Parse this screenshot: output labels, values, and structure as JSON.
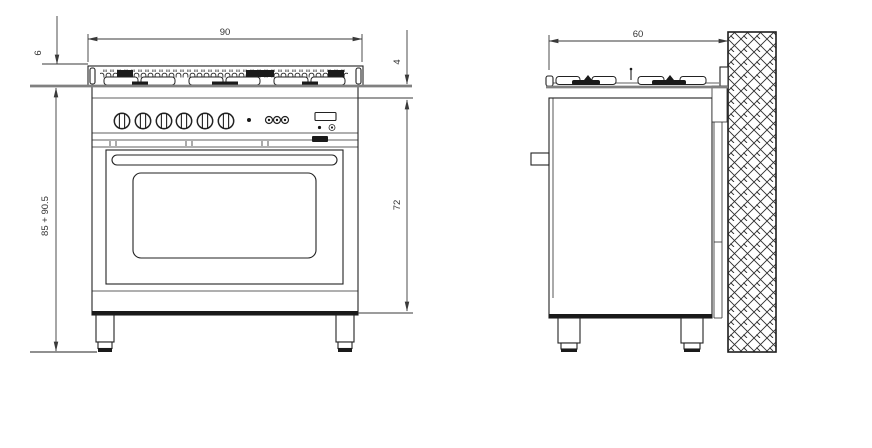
{
  "drawing": {
    "dimensions": {
      "front_width": "90",
      "hob_height": "6",
      "overall_height": "85 + 90.5",
      "top_trim_height": "4",
      "body_height": "72",
      "depth": "60"
    },
    "colors": {
      "line": "#222222",
      "dimension_line": "#3a3a3a",
      "dark_fill": "#1a1a1a",
      "worktop_gray": "#808080",
      "background": "#ffffff"
    }
  }
}
